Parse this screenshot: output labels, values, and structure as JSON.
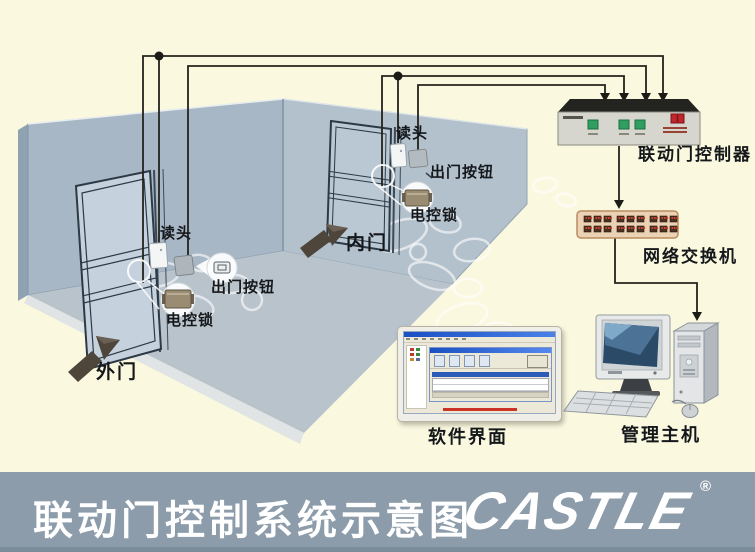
{
  "banner": {
    "title": "联动门控制系统示意图",
    "logo_text": "CASTLE",
    "registered_mark": "®",
    "bg_color": "#8C9CAA",
    "text_color": "#FFFFFF"
  },
  "labels": {
    "controller": "联动门控制器",
    "network_switch": "网络交换机",
    "software_ui": "软件界面",
    "management_host": "管理主机",
    "outer_door": "外门",
    "inner_door": "内门",
    "outer_reader": "读头",
    "outer_exit_button": "出门按钮",
    "outer_lock": "电控锁",
    "inner_reader": "读头",
    "inner_exit_button": "出门按钮",
    "inner_lock": "电控锁"
  },
  "colors": {
    "background": "#FAF8DF",
    "wall": "#A7B7C6",
    "wall_light": "#B3C1CD",
    "floor": "#B8C3CC",
    "wire": "#23231C",
    "controller_button_green": "#2F9E5F",
    "controller_switch_red": "#C0272D",
    "network_switch_body": "#ECD2B4",
    "direction_arrow": "#4E453B"
  }
}
